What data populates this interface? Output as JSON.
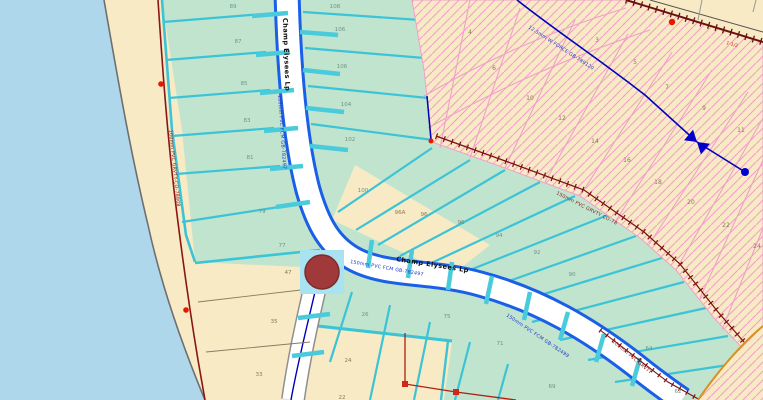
{
  "map": {
    "street_labels": {
      "loop_vertical": "Champ Elysees Lp",
      "loop_horizontal": "Champ Elysees Lp"
    },
    "utility_labels": {
      "shore_gravity": "100mm PVC GRVTY-CO-78808",
      "loop_force_vertical": "150mm PVC FCM GB-782497",
      "loop_force_horizontal": "150mm PVC FCM GB-782497",
      "promenade_force": "150mm PVC FCM GB-782499",
      "hatch_force_main": "12.5mm W FORCE GB-789120",
      "boundary_gravity": "150mm PVC GRVTY CO-78",
      "corner_note": "1-1/2",
      "southeast_gravity": "100mm PVC GRVTY"
    },
    "parcels": [
      {
        "n": "89"
      },
      {
        "n": "87"
      },
      {
        "n": "85"
      },
      {
        "n": "83"
      },
      {
        "n": "81"
      },
      {
        "n": "79"
      },
      {
        "n": "77"
      },
      {
        "n": "108"
      },
      {
        "n": "106"
      },
      {
        "n": "106"
      },
      {
        "n": "104"
      },
      {
        "n": "102"
      },
      {
        "n": "100"
      },
      {
        "n": "96A"
      },
      {
        "n": "96"
      },
      {
        "n": "96"
      },
      {
        "n": "94"
      },
      {
        "n": "92"
      },
      {
        "n": "90"
      },
      {
        "n": "26"
      },
      {
        "n": "75"
      },
      {
        "n": "71"
      },
      {
        "n": "69"
      },
      {
        "n": "64"
      },
      {
        "n": "62"
      },
      {
        "n": "47"
      },
      {
        "n": "35"
      },
      {
        "n": "33"
      },
      {
        "n": "24"
      },
      {
        "n": "22"
      },
      {
        "n": "4"
      },
      {
        "n": "3"
      },
      {
        "n": "5"
      },
      {
        "n": "6"
      },
      {
        "n": "7"
      },
      {
        "n": "10"
      },
      {
        "n": "9"
      },
      {
        "n": "12"
      },
      {
        "n": "11"
      },
      {
        "n": "14"
      },
      {
        "n": "16"
      },
      {
        "n": "18"
      },
      {
        "n": "20"
      },
      {
        "n": "22"
      },
      {
        "n": "24"
      }
    ],
    "colors": {
      "water": "#AFD7EC",
      "land": "#F7EAC4",
      "parcel_fill": "#C1E4CE",
      "parcel_border": "#3BC3D6",
      "street_casing_blue": "#1A5FE8",
      "hatch_pink": "#F2A0C8",
      "force_main_blue": "#0000BE",
      "gravity_line_red": "#8B1616",
      "marker_red": "#E81800",
      "selected_point": "#A03A3A",
      "selection_halo": "#A9E2F0"
    }
  }
}
